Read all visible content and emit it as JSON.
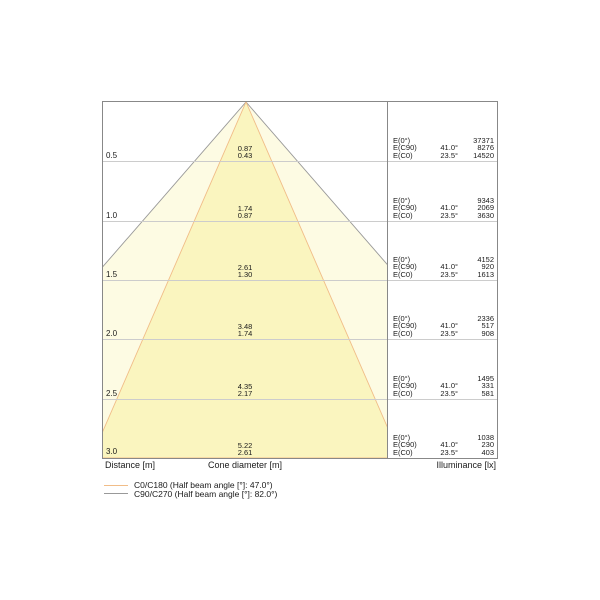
{
  "chart_data": {
    "type": "other",
    "subtype": "photometric-cone-diagram",
    "title": "",
    "distance_axis_label": "Distance [m]",
    "cone_axis_label": "Cone diameter [m]",
    "illuminance_axis_label": "Illuminance [lx]",
    "distance_range_m": [
      0,
      3.0
    ],
    "grid_step_m": 0.5,
    "e_labels": {
      "e0": "E(0°)",
      "ec90": "E(C90)",
      "ec0": "E(C0)"
    },
    "angles": {
      "c90": "41.0°",
      "c0": "23.5°"
    },
    "rows": [
      {
        "distance": "0.5",
        "d_c90": "0.87",
        "d_c0": "0.43",
        "e0": "37371",
        "ec90": "8276",
        "ec0": "14520"
      },
      {
        "distance": "1.0",
        "d_c90": "1.74",
        "d_c0": "0.87",
        "e0": "9343",
        "ec90": "2069",
        "ec0": "3630"
      },
      {
        "distance": "1.5",
        "d_c90": "2.61",
        "d_c0": "1.30",
        "e0": "4152",
        "ec90": "920",
        "ec0": "1613"
      },
      {
        "distance": "2.0",
        "d_c90": "3.48",
        "d_c0": "1.74",
        "e0": "2336",
        "ec90": "517",
        "ec0": "908"
      },
      {
        "distance": "2.5",
        "d_c90": "4.35",
        "d_c0": "2.17",
        "e0": "1495",
        "ec90": "331",
        "ec0": "581"
      },
      {
        "distance": "3.0",
        "d_c90": "5.22",
        "d_c0": "2.61",
        "e0": "1038",
        "ec90": "230",
        "ec0": "403"
      }
    ],
    "beams": [
      {
        "name": "C0/C180",
        "half_beam_angle_deg": 47.0,
        "line_color": "#f1bd88",
        "fill_color": "#faf5bf"
      },
      {
        "name": "C90/C270",
        "half_beam_angle_deg": 82.0,
        "line_color": "#999999",
        "fill_color": "#fdfbe3"
      }
    ],
    "colors": {
      "grid": "#cccccc",
      "border": "#888888",
      "text": "#1a1a1a",
      "background": "#ffffff"
    }
  },
  "legend": {
    "items": [
      {
        "label": "C0/C180 (Half beam angle [°]: 47.0°)"
      },
      {
        "label": "C90/C270 (Half beam angle [°]: 82.0°)"
      }
    ]
  }
}
